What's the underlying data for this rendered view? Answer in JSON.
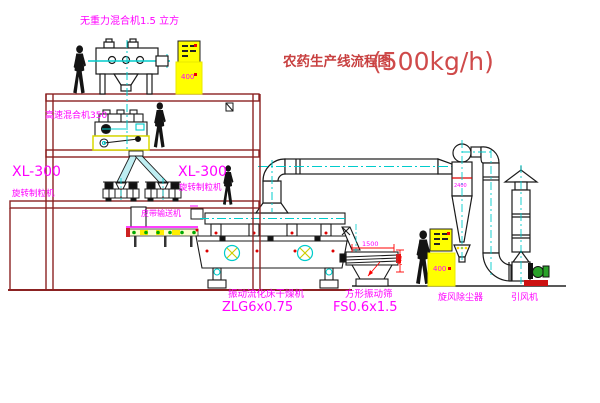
{
  "title": {
    "text": "农药生产线流程图",
    "capacity": "(500kg/h)"
  },
  "labels": {
    "gravity_free_mixer": "无重力混合机1.5 立方",
    "high_speed_mixer": "高速混合机350",
    "granulator_1_model": "XL-300",
    "granulator_1_name": "旋转制粒机",
    "granulator_2_model": "XL-300",
    "granulator_2_name": "旋转制粒机",
    "belt_conveyor": "皮带输送机",
    "dryer_name": "振动流化床干燥机",
    "dryer_model": "ZLG6x0.75",
    "sieve_name": "方形振动筛",
    "sieve_model": "FS0.6x1.5",
    "cyclone": "旋风除尘器",
    "fan": "引风机"
  },
  "annotations": {
    "cabinet_1": "400",
    "cabinet_2": "400",
    "cyclone_dim": "2400",
    "sieve_length": "1500",
    "sieve_height": "745"
  },
  "colors": {
    "label_magenta": "#ff00ff",
    "title_red": "#c84040",
    "dimension_red": "#ff0000",
    "building_maroon": "#8b2222",
    "centerline_cyan": "#00cccc",
    "cabinet_yellow": "#ffff00",
    "machine_black": "#1a1a1a",
    "fan_green": "#2aa22a"
  }
}
